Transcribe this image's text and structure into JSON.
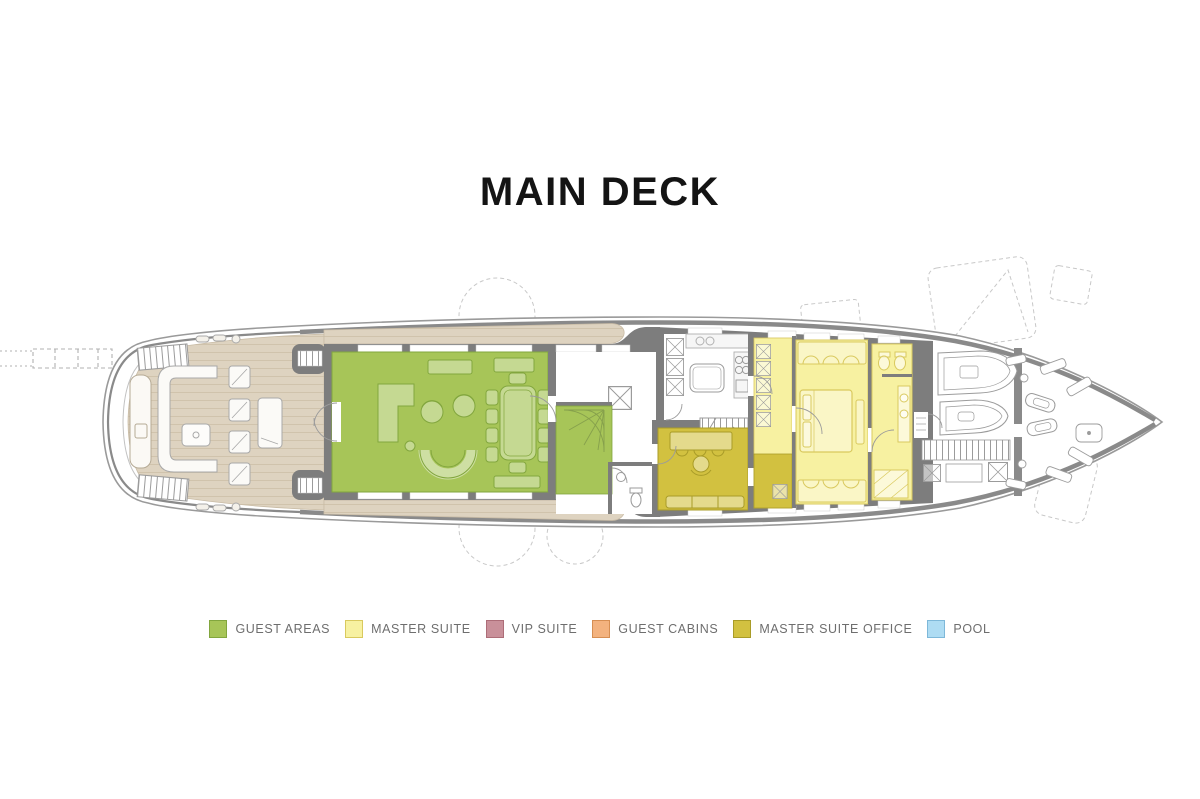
{
  "title": "MAIN DECK",
  "legend": {
    "label_color": "#6e6e6e",
    "items": [
      {
        "id": "guest-areas",
        "label": "GUEST AREAS",
        "fill": "#a7c558",
        "border": "#82a63e"
      },
      {
        "id": "master-suite",
        "label": "MASTER SUITE",
        "fill": "#f7f1a1",
        "border": "#d9c95e"
      },
      {
        "id": "vip-suite",
        "label": "VIP SUITE",
        "fill": "#c9909a",
        "border": "#ad6d78"
      },
      {
        "id": "guest-cabins",
        "label": "GUEST CABINS",
        "fill": "#f3b27e",
        "border": "#d68e52"
      },
      {
        "id": "master-suite-office",
        "label": "MASTER SUITE OFFICE",
        "fill": "#d2c140",
        "border": "#a99c28"
      },
      {
        "id": "pool",
        "label": "POOL",
        "fill": "#aedcf3",
        "border": "#7eb8d9"
      }
    ]
  },
  "plan": {
    "colors": {
      "background": "#ffffff",
      "title_color": "#141414",
      "deck_teak": "#ded3c0",
      "deck_plank_line": "#d0c3ac",
      "walls": "#7d7d7d",
      "bulwark": "#8a8a8a",
      "hull_line": "#9a9a9a",
      "furniture_line": "#9b9b9b",
      "dashed_guide": "#c8c8c8"
    }
  }
}
